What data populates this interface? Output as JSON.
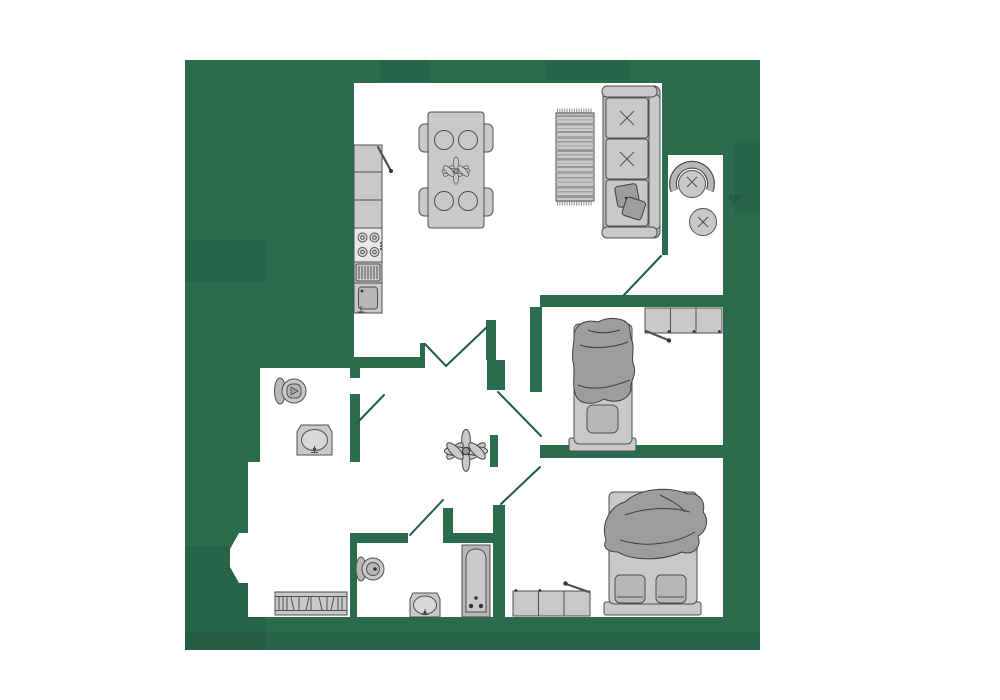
{
  "title": "apartment-floor-plan",
  "palette": {
    "page_bg": "#ffffff",
    "plan_green": "#2b6b4e",
    "floor_white": "#ffffff",
    "furniture_light": "#c9c9c9",
    "furniture_mid": "#b7b7b7",
    "furniture_dark": "#9d9d9d",
    "furniture_pale": "#d8d8d8",
    "stove_panel": "#e8e8e8",
    "outline": "#4f4f4f",
    "blanket_outline": "#3f3f3f",
    "door_line": "#1e5c41",
    "dot": "#333333",
    "rug_a": "#989898",
    "rug_b": "#b2b2b2",
    "rug_c": "#a5a5a5",
    "fringe": "#8a8a8a"
  },
  "rooms": [
    {
      "name": "kitchen-living-room"
    },
    {
      "name": "balcony"
    },
    {
      "name": "bedroom-1"
    },
    {
      "name": "bedroom-2"
    },
    {
      "name": "wc"
    },
    {
      "name": "bathroom"
    },
    {
      "name": "hallway"
    },
    {
      "name": "entrance-hall"
    }
  ],
  "furniture": [
    "kitchen-counter",
    "fridge",
    "stove",
    "drying-rack",
    "kitchen-sink",
    "dining-table",
    "dining-chairs",
    "table-plant",
    "rug",
    "sofa",
    "throw-pillows",
    "round-armchair",
    "round-side-table",
    "wardrobe-shelf",
    "single-bed",
    "double-bed",
    "dresser",
    "wc-toilet",
    "wc-washbasin",
    "bath-toilet",
    "bath-washbasin",
    "bathtub",
    "radiator-bench",
    "hall-plant"
  ]
}
